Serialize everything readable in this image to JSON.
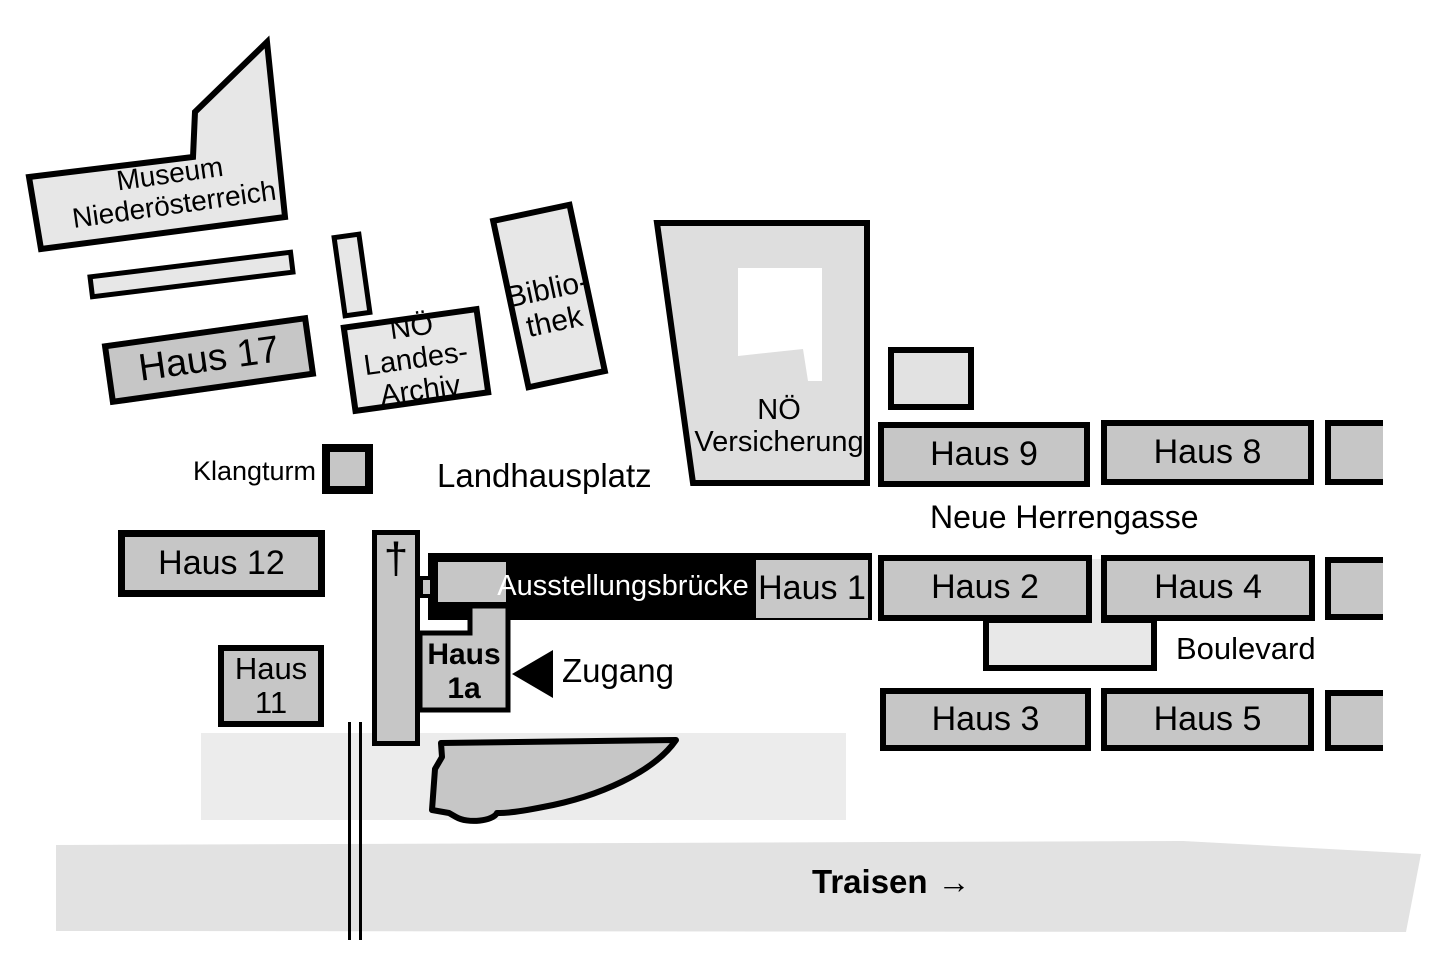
{
  "colors": {
    "building_light": "#e7e7e7",
    "building_medium": "#c6c6c6",
    "versicherung_fill": "#dedede",
    "plaza_band": "#ececec",
    "river_band": "#e2e2e2",
    "boulevard_connector": "#e8e8e8",
    "bridge_bar": "#000000",
    "bridge_text": "#ffffff"
  },
  "buildings": {
    "museum": {
      "line1": "Museum",
      "line2": "Niederösterreich"
    },
    "haus17": {
      "label": "Haus 17"
    },
    "landesarchiv": {
      "line1": "NÖ Landes-",
      "line2": "Archiv"
    },
    "bibliothek": {
      "line1": "Biblio-",
      "line2": "thek"
    },
    "versicherung": {
      "line1": "NÖ",
      "line2": "Versicherung"
    },
    "haus9": {
      "label": "Haus 9"
    },
    "haus8": {
      "label": "Haus 8"
    },
    "haus12": {
      "label": "Haus 12"
    },
    "haus11": {
      "line1": "Haus",
      "line2": "11"
    },
    "kapellenturm": {
      "symbol": "†"
    },
    "ausstellungsbruecke": {
      "label": "Ausstellungsbrücke"
    },
    "haus1": {
      "label": "Haus 1"
    },
    "haus1a": {
      "line1": "Haus",
      "line2": "1a"
    },
    "haus2": {
      "label": "Haus 2"
    },
    "haus4": {
      "label": "Haus 4"
    },
    "haus3": {
      "label": "Haus 3"
    },
    "haus5": {
      "label": "Haus 5"
    }
  },
  "areas": {
    "klangturm": "Klangturm",
    "landhausplatz": "Landhausplatz",
    "neue_herrengasse": "Neue Herrengasse",
    "boulevard": "Boulevard",
    "zugang": "Zugang",
    "traisen": "Traisen",
    "traisen_arrow": "→"
  }
}
